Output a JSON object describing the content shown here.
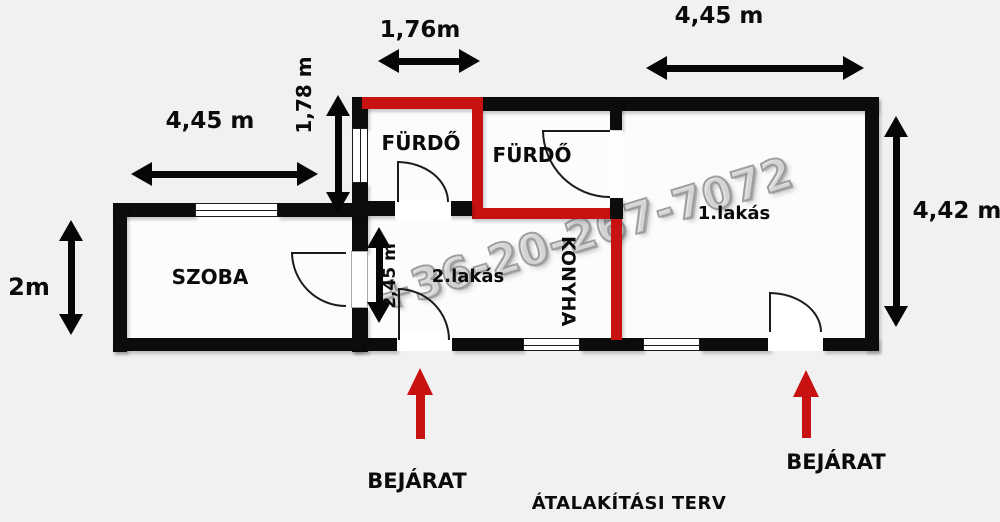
{
  "title": "ÁTALAKÍTÁSI TERV",
  "watermark": "+36-20-267-7072",
  "rooms": {
    "bathroom1": "FÜRDŐ",
    "bathroom2": "FÜRDŐ",
    "room": "SZOBA",
    "kitchen": "KONYHA",
    "apartment1": "1.lakás",
    "apartment2": "2.lakás"
  },
  "dimensions": {
    "top_small": "1,76m",
    "top_right": "4,45 m",
    "left_top": "4,45 m",
    "left_vertical": "1,78 m",
    "inner_vertical": "2,45 m",
    "right_vertical": "4,42 m",
    "left_small": "2m"
  },
  "entrances": {
    "left_label": "BEJÁRAT",
    "right_label": "BEJÁRAT"
  },
  "colors": {
    "wall_black": "#0c0c0c",
    "wall_new_red": "#c81212",
    "entrance_arrow_red": "#c81212",
    "background": "#f1f1f1",
    "floor_white": "#fcfcfc",
    "watermark_gray": "#a9a9a9"
  }
}
